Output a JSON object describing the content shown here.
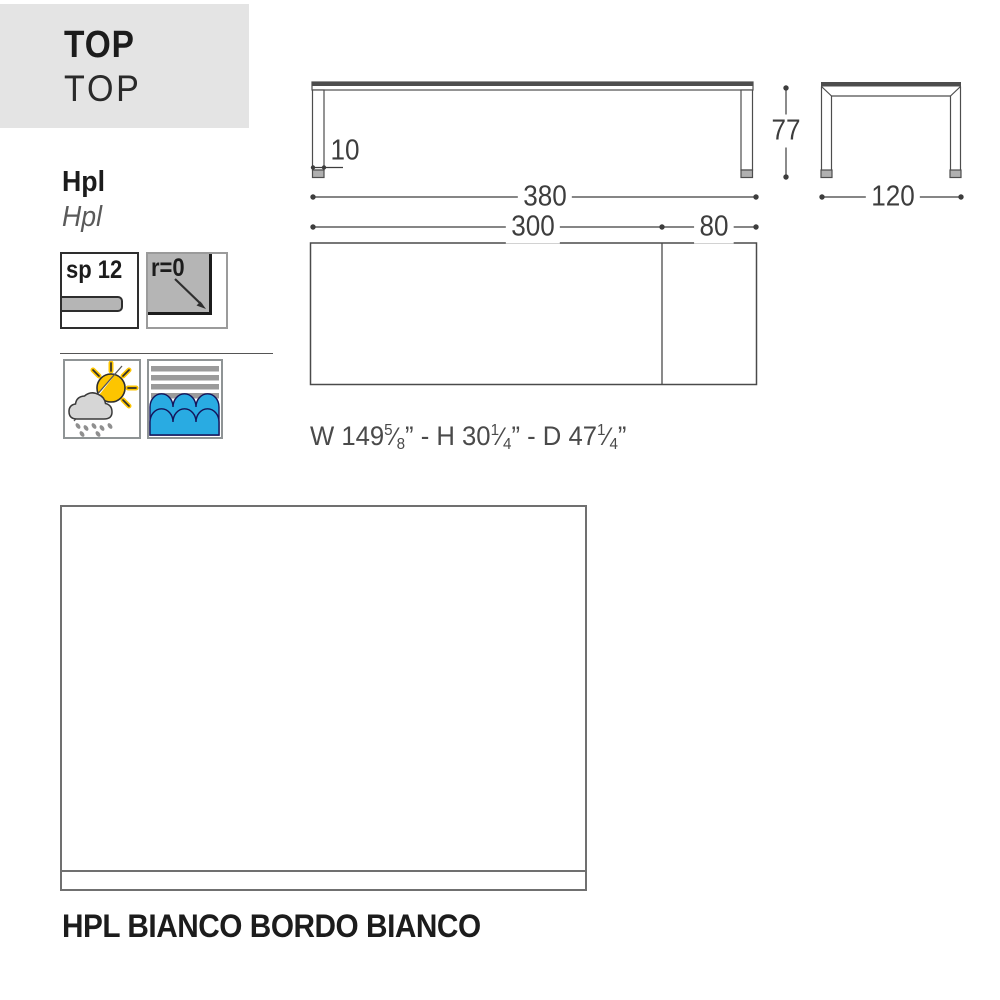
{
  "header": {
    "title_bold": "TOP",
    "title_regular": "TOP"
  },
  "material": {
    "name": "Hpl",
    "name_alt": "Hpl"
  },
  "badges": {
    "thickness_label": "sp 12",
    "radius_label": "r=0"
  },
  "dimensions": {
    "total_width": "380",
    "main_width": "300",
    "extension": "80",
    "height": "77",
    "leg_thickness": "10",
    "depth": "120"
  },
  "imperial": {
    "p0": "W 149",
    "p1": "5",
    "p2": "⁄",
    "p3": "8",
    "p4": "” - H 30",
    "p5": "1",
    "p6": "⁄",
    "p7": "4",
    "p8": "” - D 47",
    "p9": "1",
    "p10": "⁄",
    "p11": "4",
    "p12": "”"
  },
  "finish": {
    "label": "HPL BIANCO BORDO BIANCO"
  },
  "colors": {
    "panel_bg": "#e4e4e4",
    "wave_blue": "#29abe2",
    "sun_yellow": "#fdc500",
    "icon_gray": "#b5b5b5",
    "line_gray": "#3d3d3d"
  }
}
